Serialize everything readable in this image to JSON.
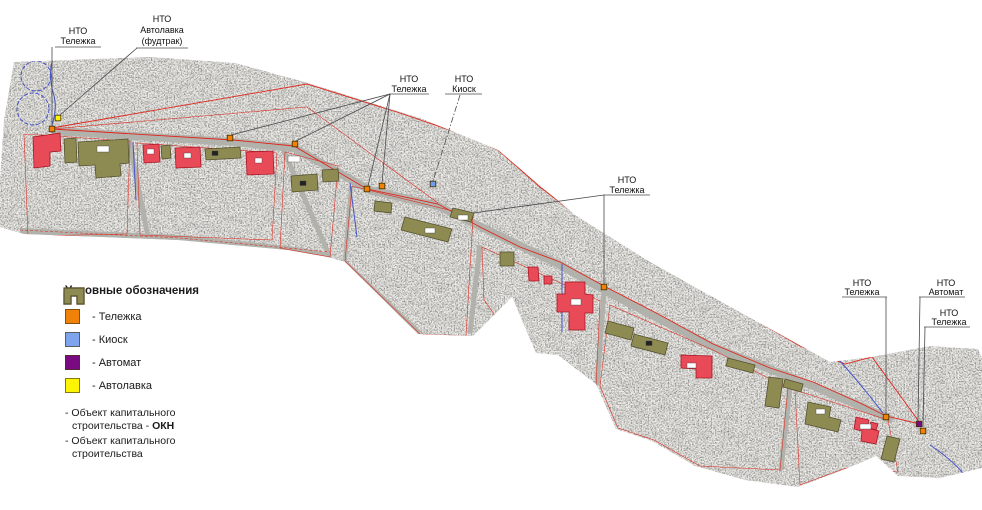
{
  "canvas": {
    "width": 982,
    "height": 510,
    "background": "#ffffff"
  },
  "map": {
    "colors": {
      "telezhka": "#F0820A",
      "kiosk": "#6F9CEC",
      "avtomat": "#7A0A82",
      "avtolavka": "#FCF403",
      "okn_fill": "#E84A58",
      "okn_stroke": "#A81624",
      "oks_fill": "#8D8A52",
      "oks_stroke": "#54512E",
      "boundary_red": "#E0251B",
      "hydro_blue": "#4553C8",
      "terrain": "#efeeea",
      "street": "#b4b4ae"
    },
    "callouts": [
      {
        "id": "c1",
        "lines": [
          "НТО",
          "Тележка"
        ]
      },
      {
        "id": "c2",
        "lines": [
          "НТО",
          "Автолавка",
          "(фудтрак)"
        ]
      },
      {
        "id": "c3",
        "lines": [
          "НТО",
          "Тележка"
        ]
      },
      {
        "id": "c4",
        "lines": [
          "НТО",
          "Киоск"
        ]
      },
      {
        "id": "c5",
        "lines": [
          "НТО",
          "Тележка"
        ]
      },
      {
        "id": "c6",
        "lines": [
          "НТО",
          "Тележка"
        ]
      },
      {
        "id": "c7",
        "lines": [
          "НТО",
          "Автомат"
        ]
      },
      {
        "id": "c8",
        "lines": [
          "НТО",
          "Тележка"
        ]
      }
    ],
    "markers": [
      {
        "type": "telezhka",
        "x": 52,
        "y": 129
      },
      {
        "type": "avtolavka",
        "x": 58,
        "y": 118
      },
      {
        "type": "telezhka",
        "x": 230,
        "y": 138
      },
      {
        "type": "telezhka",
        "x": 295,
        "y": 144
      },
      {
        "type": "telezhka",
        "x": 367,
        "y": 189
      },
      {
        "type": "telezhka",
        "x": 382,
        "y": 186
      },
      {
        "type": "kiosk",
        "x": 433,
        "y": 184
      },
      {
        "type": "telezhka",
        "x": 604,
        "y": 287
      },
      {
        "type": "telezhka",
        "x": 886,
        "y": 417
      },
      {
        "type": "avtomat",
        "x": 919,
        "y": 424
      },
      {
        "type": "telezhka",
        "x": 923,
        "y": 431
      }
    ]
  },
  "legend": {
    "title": "Условные обозначения",
    "items": [
      {
        "key": "telezhka",
        "label": "- Тележка",
        "color": "#F0820A"
      },
      {
        "key": "kiosk",
        "label": "- Киоск",
        "color": "#7FA4EE"
      },
      {
        "key": "avtomat",
        "label": "- Автомат",
        "color": "#7A0A82"
      },
      {
        "key": "avtolavka",
        "label": "- Автолавка",
        "color": "#FCF403"
      }
    ],
    "building_items": [
      {
        "key": "okn",
        "line1": "- Объект капитального",
        "line2_prefix": "строительства - ",
        "line2_bold": "ОКН",
        "color": "#E84A58",
        "border": "#8B1A1A"
      },
      {
        "key": "oks",
        "line1": "- Объект капитального",
        "line2_prefix": "строительства",
        "line2_bold": "",
        "color": "#8D8A52",
        "border": "#54512E"
      }
    ]
  }
}
